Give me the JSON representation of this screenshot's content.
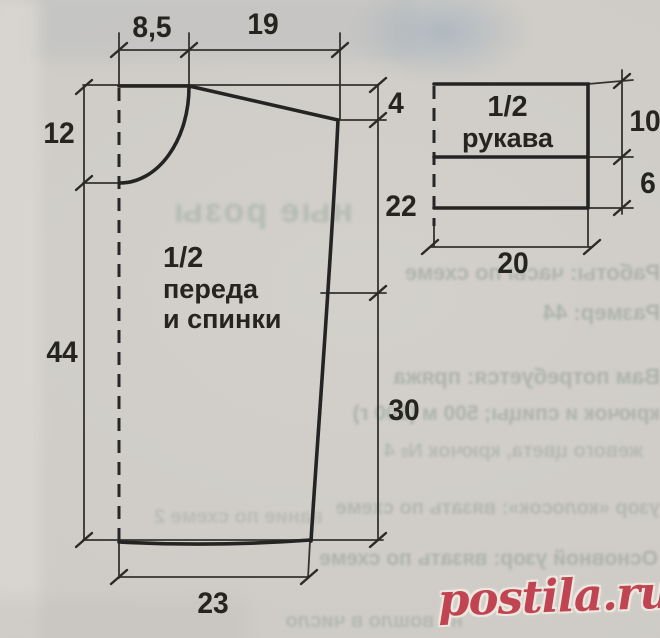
{
  "diagram": {
    "main_piece": {
      "label": [
        "1/2",
        "переда",
        "и спинки"
      ],
      "measurements": {
        "neck_width": "8,5",
        "shoulder_width": "19",
        "neck_depth": "12",
        "shoulder_drop": "4",
        "armhole_depth": "22",
        "length_below_neck": "44",
        "side_below_armhole": "30",
        "half_hem_width": "23"
      }
    },
    "sleeve_piece": {
      "label": [
        "1/2",
        "рукава"
      ],
      "measurements": {
        "upper_height": "10",
        "lower_height": "6",
        "half_width": "20"
      }
    }
  },
  "ghost_bleedthrough": {
    "headline": "ные розы",
    "lines": [
      "Работы: часы по схеме",
      "Размер: 44",
      "Вам потребуется: пряжа",
      "крючок и спицы; 500 м (100 г)",
      "жевого цвета, крючок № 4",
      "узор «колосок»: вязать по схеме",
      "Основной узор: вязать по схеме",
      "вание по схеме 2",
      "не вошло в число"
    ]
  },
  "watermark": {
    "text": "postila.ru",
    "color": "#c04451"
  },
  "colors": {
    "paper": "#cfccc7",
    "ink": "#242424",
    "ghost": "#94a094"
  }
}
